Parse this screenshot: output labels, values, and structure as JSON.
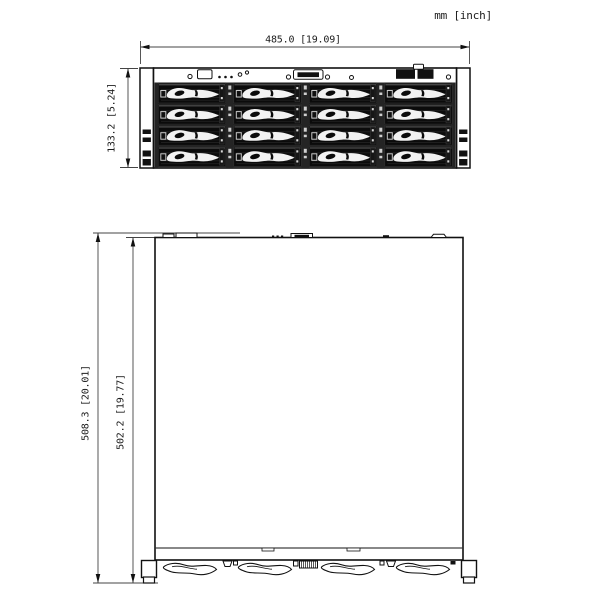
{
  "units_label": "mm [inch]",
  "front_view": {
    "name": "front-elevation-view",
    "width_dim": "485.0 [19.09]",
    "height_dim": "133.2 [5.24]",
    "drive_bays": {
      "rows": 4,
      "cols": 4
    },
    "panel_icons": [
      "screw-icon",
      "vga-port-icon",
      "status-led-dots-icon",
      "ir-receiver-icon",
      "dvi-port-icon",
      "usb-ports-icon",
      "power-button-icon",
      "screw-icon"
    ]
  },
  "top_view": {
    "name": "top-plan-view",
    "depth_overall_dim": "508.3 [20.01]",
    "depth_chassis_dim": "502.2 [19.77]",
    "rear_handles": 4,
    "rear_icons": [
      "corner-bracket-icon",
      "handle-swoosh-icon",
      "latch-tab-icon",
      "pin-connector-icon",
      "corner-bracket-icon"
    ]
  }
}
